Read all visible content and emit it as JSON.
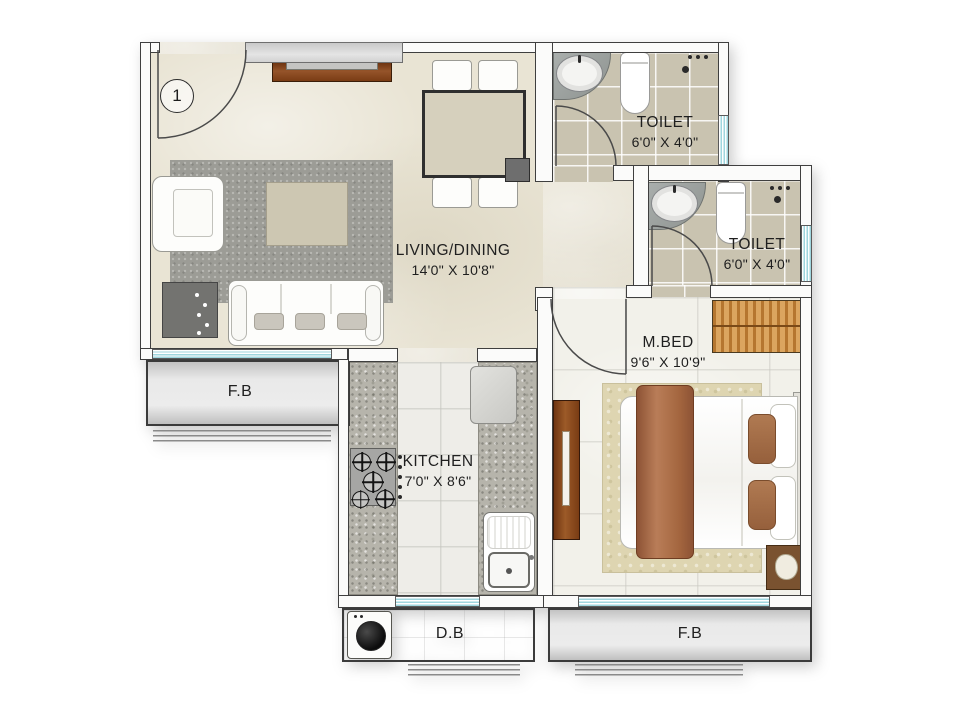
{
  "plan": {
    "unit_number": "1",
    "rooms": {
      "living": {
        "name": "LIVING/DINING",
        "dims": "14'0\" X 10'8\""
      },
      "kitchen": {
        "name": "KITCHEN",
        "dims": "7'0\" X 8'6\""
      },
      "master_bedroom": {
        "name": "M.BED",
        "dims": "9'6\" X 10'9\""
      },
      "toilet_top": {
        "name": "TOILET",
        "dims": "6'0\" X 4'0\""
      },
      "toilet_mid": {
        "name": "TOILET",
        "dims": "6'0\" X 4'0\""
      }
    },
    "areas": {
      "flower_bed_left": {
        "label": "F.B"
      },
      "flower_bed_right": {
        "label": "F.B"
      },
      "dry_balcony": {
        "label": "D.B"
      }
    },
    "colors": {
      "wall_outline": "#3f3f3f",
      "window_glass": "#9fd6de",
      "living_floor": "#e9e4d4",
      "toilet_tile": "#c9c3b0",
      "wood_brown": "#7a3c14",
      "bed_textile": "#a96a48",
      "rug_gray": "#9c9c96"
    }
  }
}
